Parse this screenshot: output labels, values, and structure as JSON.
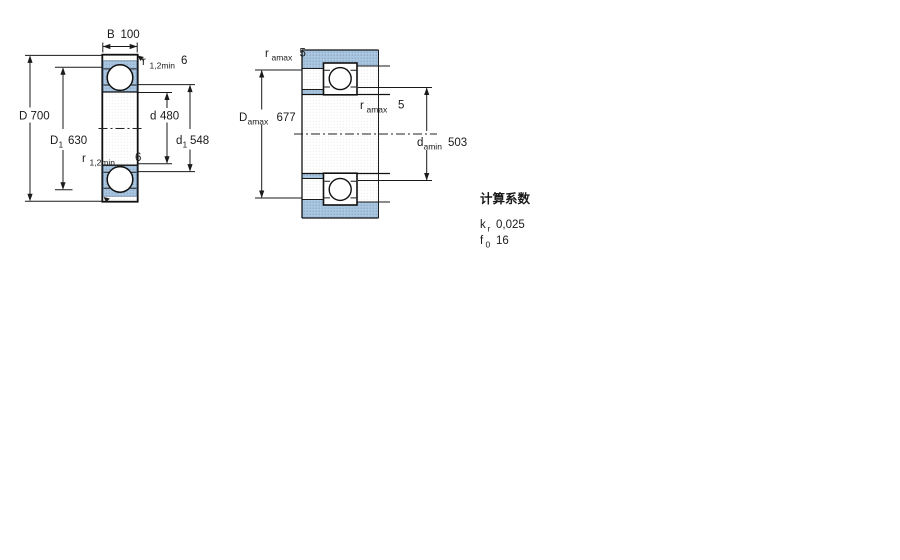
{
  "drawing_type": "bearing-cross-section-and-abutment-diagram",
  "figure_left": {
    "name": "bearing-cross-section",
    "width_dim": {
      "base": "B",
      "value": "100"
    },
    "r_top": {
      "base": "r",
      "sub": "1,2min",
      "value": "6"
    },
    "D": {
      "base": "D",
      "value": "700"
    },
    "D1": {
      "base": "D",
      "sub": "1",
      "value": "630"
    },
    "d": {
      "base": "d",
      "value": "480"
    },
    "d1": {
      "base": "d",
      "sub": "1",
      "value": "548"
    },
    "r_bottom": {
      "base": "r",
      "sub": "1,2min",
      "value": "6"
    }
  },
  "figure_right": {
    "name": "abutment-and-fillet-dimensions",
    "ra_top": {
      "base": "r",
      "sub": "amax",
      "value": "5"
    },
    "Damax": {
      "base": "D",
      "sub": "amax",
      "value": "677"
    },
    "ra_mid": {
      "base": "r",
      "sub": "amax",
      "value": "5"
    },
    "damin": {
      "base": "d",
      "sub": "amin",
      "value": "503"
    }
  },
  "calculation_factors": {
    "title": "计算系数",
    "rows": [
      {
        "base": "k",
        "sub": "r",
        "value": "0,025"
      },
      {
        "base": "f",
        "sub": "0",
        "value": "16"
      }
    ]
  },
  "colors": {
    "section_fill": "#a9c7e3",
    "section_dot": "#8fa6bd",
    "background": "#ffffff",
    "line": "#1a1a1a"
  }
}
